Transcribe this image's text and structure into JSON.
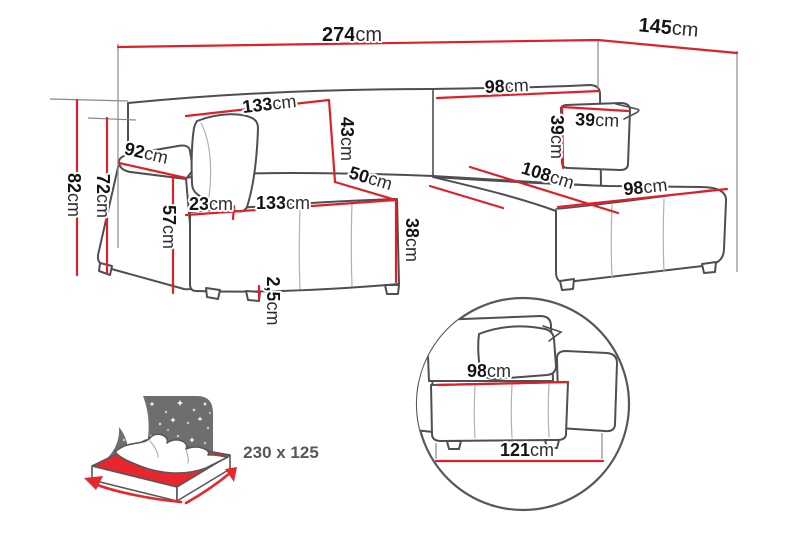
{
  "diagram": {
    "title": "corner-sofa-dimension-diagram",
    "dimensions": {
      "total_width": {
        "v": "274",
        "u": "cm"
      },
      "total_depth": {
        "v": "145",
        "u": "cm"
      },
      "backrest_left_width": {
        "v": "133",
        "u": "cm"
      },
      "backrest_right_width": {
        "v": "98",
        "u": "cm"
      },
      "backrest_cushion_height": {
        "v": "43",
        "u": "cm"
      },
      "pillow_width": {
        "v": "39",
        "u": "cm"
      },
      "pillow_height": {
        "v": "39",
        "u": "cm"
      },
      "armrest_depth": {
        "v": "92",
        "u": "cm"
      },
      "total_height": {
        "v": "82",
        "u": "cm"
      },
      "armrest_height": {
        "v": "72",
        "u": "cm"
      },
      "armrest_front_width": {
        "v": "23",
        "u": "cm"
      },
      "seat_height": {
        "v": "57",
        "u": "cm"
      },
      "seat_width": {
        "v": "133",
        "u": "cm"
      },
      "seat_to_chaise": {
        "v": "50",
        "u": "cm"
      },
      "seat_cushion_height": {
        "v": "38",
        "u": "cm"
      },
      "chaise_length": {
        "v": "108",
        "u": "cm"
      },
      "chaise_width": {
        "v": "98",
        "u": "cm"
      },
      "foot_clearance": {
        "v": "2,5",
        "u": "cm"
      }
    },
    "sleeping_area": {
      "label": "230 x 125"
    },
    "detail": {
      "seat_width": {
        "v": "98",
        "u": "cm"
      },
      "base_width": {
        "v": "121",
        "u": "cm"
      }
    },
    "icons": {
      "sleeping_function": "bed-with-starry-sky",
      "detail_view": "sofa-side-view-in-circle"
    },
    "colors": {
      "dimension_line": "#de2129",
      "outline": "#4f4f51",
      "icon_gray": "#6d6e70",
      "icon_red": "#e8262d"
    }
  }
}
